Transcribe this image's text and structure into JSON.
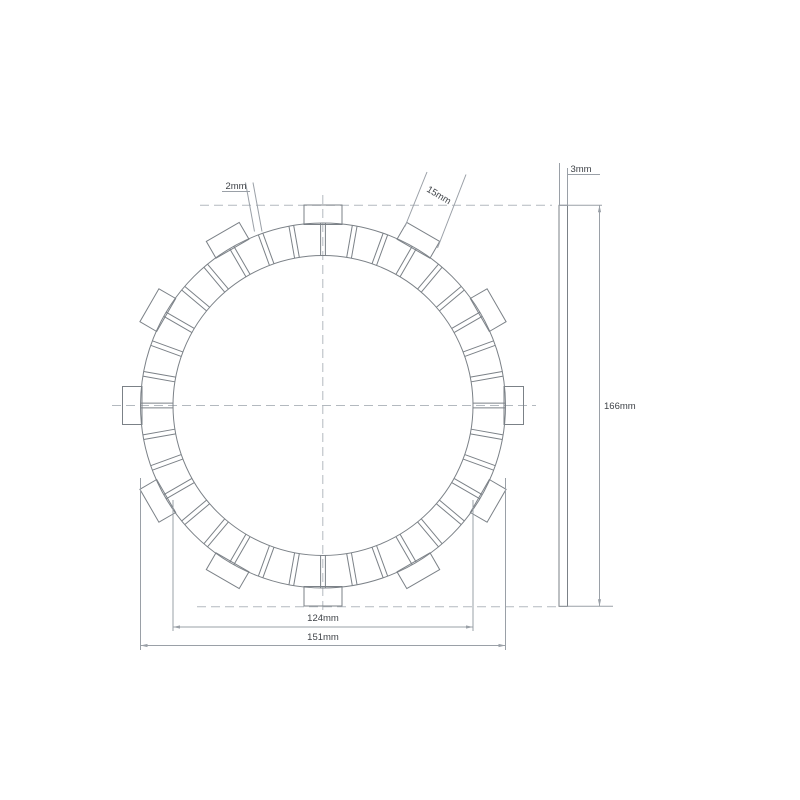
{
  "title": "Clutch friction plate technical drawing",
  "dimensions": {
    "slot_width": "2mm",
    "tab_width": "15mm",
    "thickness": "3mm",
    "overall_diameter": "166mm",
    "inner_diameter": "124mm",
    "friction_ring_diameter": "151mm"
  },
  "geometry": {
    "center_x": 323,
    "center_y": 405.5,
    "ring_inner_radius_px": 150,
    "ring_outer_radius_px": 182.5,
    "tab_outer_radius_px": 200.5,
    "tab_inner_radius_px": 181,
    "pad_count": 36,
    "tab_count": 12,
    "slot_half_width_px": 2.4,
    "tab_width_px": 38,
    "side_view": {
      "x": 559,
      "y": 205.3,
      "width": 8.5,
      "height": 401
    },
    "colors": {
      "line": "#7b8187",
      "dim": "#9aa0a7",
      "dash": "#b3b9bf",
      "text": "#3f4348",
      "background": "#ffffff"
    }
  }
}
